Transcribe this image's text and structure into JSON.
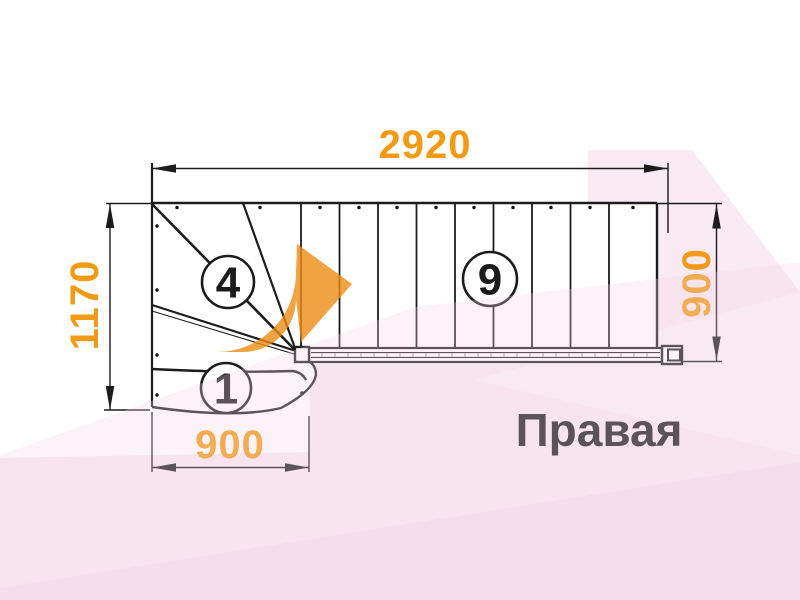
{
  "title": "Правая",
  "dimensions": {
    "top_width": "2920",
    "left_height": "1170",
    "right_height": "900",
    "bottom_width": "900"
  },
  "step_labels": {
    "first_step": "1",
    "winder_step": "4",
    "mid_flight_step": "9"
  },
  "colors": {
    "dimension_text": "#f39a14",
    "direction_arrow": "#ec8c13",
    "line": "#1c1c1c",
    "background_wash": "#f9eaf3"
  }
}
